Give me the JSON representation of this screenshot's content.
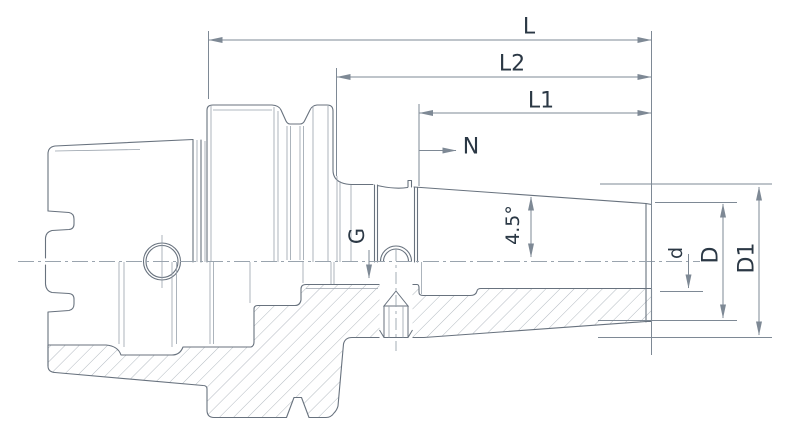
{
  "drawing": {
    "title": "shrink-fit tool holder section drawing",
    "dimension_labels": {
      "overall_length": "L",
      "length_l2": "L2",
      "length_l1": "L1",
      "nose_ref": "N",
      "thread": "G",
      "taper_angle": "4.5°",
      "bore_diameter": "d",
      "nose_diameter": "D",
      "body_diameter": "D1"
    },
    "colors": {
      "label_text": "#2b3845",
      "outline": "#68727e",
      "thin_line": "#98a1ab",
      "dimension_line": "#7e8995",
      "hatch": "#aab2ba",
      "background": "#ffffff"
    }
  }
}
